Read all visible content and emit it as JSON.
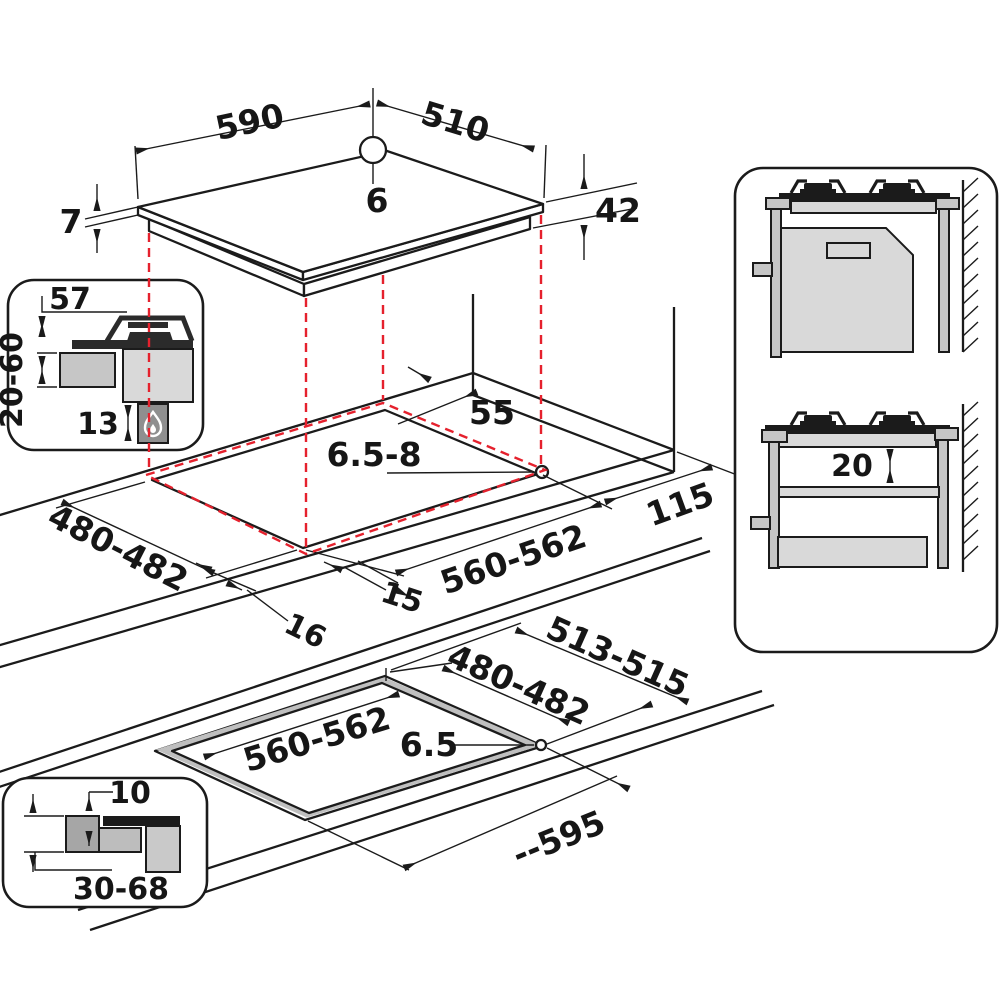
{
  "title": "Gas hob built-in installation diagram",
  "colors": {
    "projection_red": "#e5212d",
    "outline": "#1b1b1b",
    "light_gray": "#d9d9d9",
    "mid_gray": "#c6c6c6",
    "flame_box_gray": "#8f8f8f"
  },
  "labels": {
    "hob_width": "590",
    "hob_depth": "510",
    "hole_offset": "6",
    "glass_thickness": "7",
    "built_in_depth": "42",
    "burner_height": "57",
    "worktop_thickness_range": "20-60",
    "clearance_below": "13",
    "rear_clearance": "55",
    "screw_hole_mid": "6.5-8",
    "side_clearance": "115",
    "cutout_depth_mid": "480-482",
    "overhang_16": "16",
    "overhang_15": "15",
    "cutout_width_mid": "560-562",
    "flush_outer_depth": "513-515",
    "flush_cutout_depth": "480-482",
    "flush_cutout_width": "560-562",
    "screw_hole_flush": "6.5",
    "flush_max_width": "--595",
    "flush_step_depth": "10",
    "flush_worktop_thickness": "30-68",
    "shelf_clearance": "20"
  }
}
